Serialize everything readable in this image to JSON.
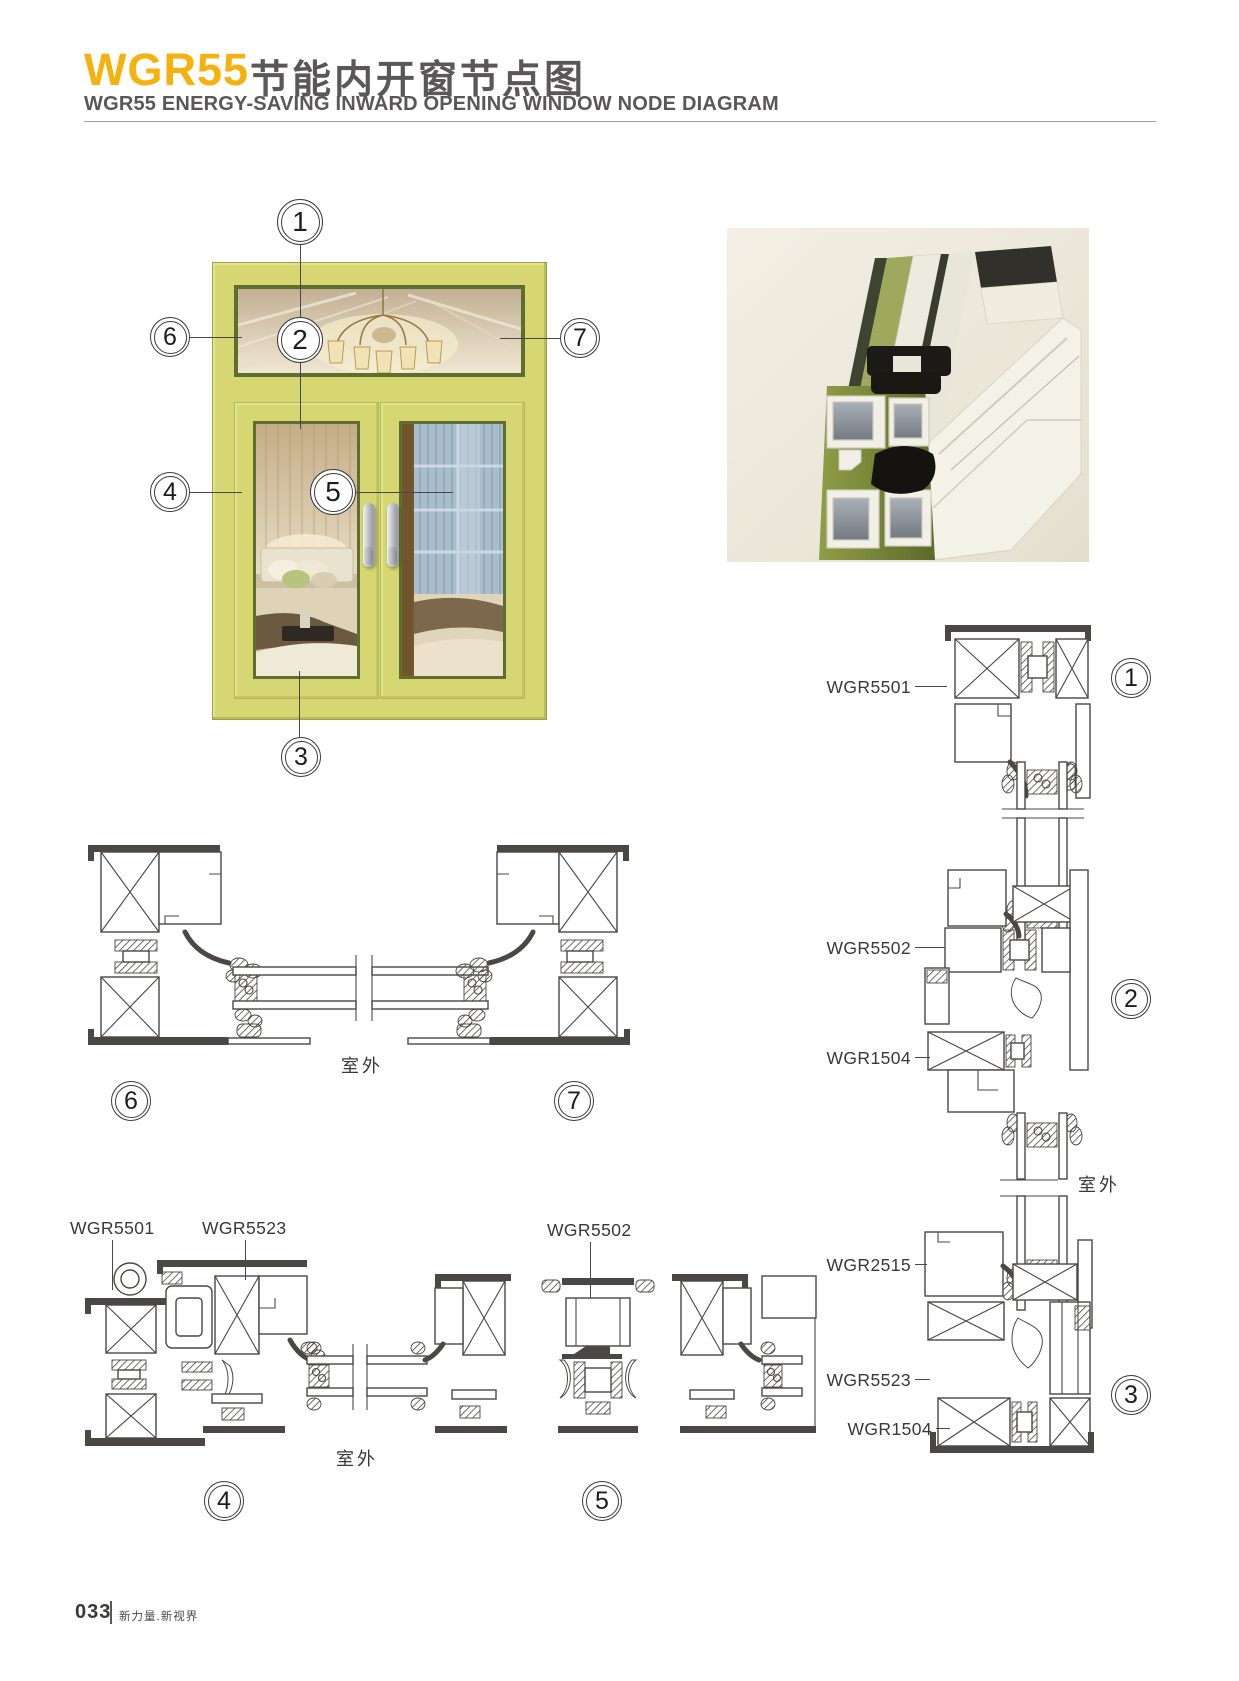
{
  "header": {
    "series": "WGR55",
    "title_cn": "节能内开窗节点图",
    "subtitle_en": "WGR55 ENERGY-SAVING INWARD OPENING WINDOW NODE DIAGRAM"
  },
  "window_figure": {
    "callouts": [
      {
        "num": "1"
      },
      {
        "num": "2"
      },
      {
        "num": "3"
      },
      {
        "num": "4"
      },
      {
        "num": "5"
      },
      {
        "num": "6"
      },
      {
        "num": "7"
      }
    ]
  },
  "section_67": {
    "outdoor": "室外",
    "callout_left": "6",
    "callout_right": "7"
  },
  "section_45": {
    "label_frame": "WGR5501",
    "label_sash": "WGR5523",
    "label_mullion": "WGR5502",
    "outdoor": "室外",
    "callout_left": "4",
    "callout_right": "5"
  },
  "section_right": {
    "node1_label": "WGR5501",
    "node1_num": "1",
    "node2_label_top": "WGR5502",
    "node2_label_bottom": "WGR1504",
    "node2_num": "2",
    "outdoor": "室外",
    "node3_label_top": "WGR2515",
    "node3_label_mid": "WGR5523",
    "node3_label_bottom": "WGR1504",
    "node3_num": "3"
  },
  "footer": {
    "page_number": "033",
    "slogan": "新力量.新视界"
  },
  "colors": {
    "accent": "#F7B10D",
    "ink": "#595757",
    "line": "#4A4744",
    "frame_green": "#D6D773",
    "render_bg": "#EFEBDF"
  }
}
